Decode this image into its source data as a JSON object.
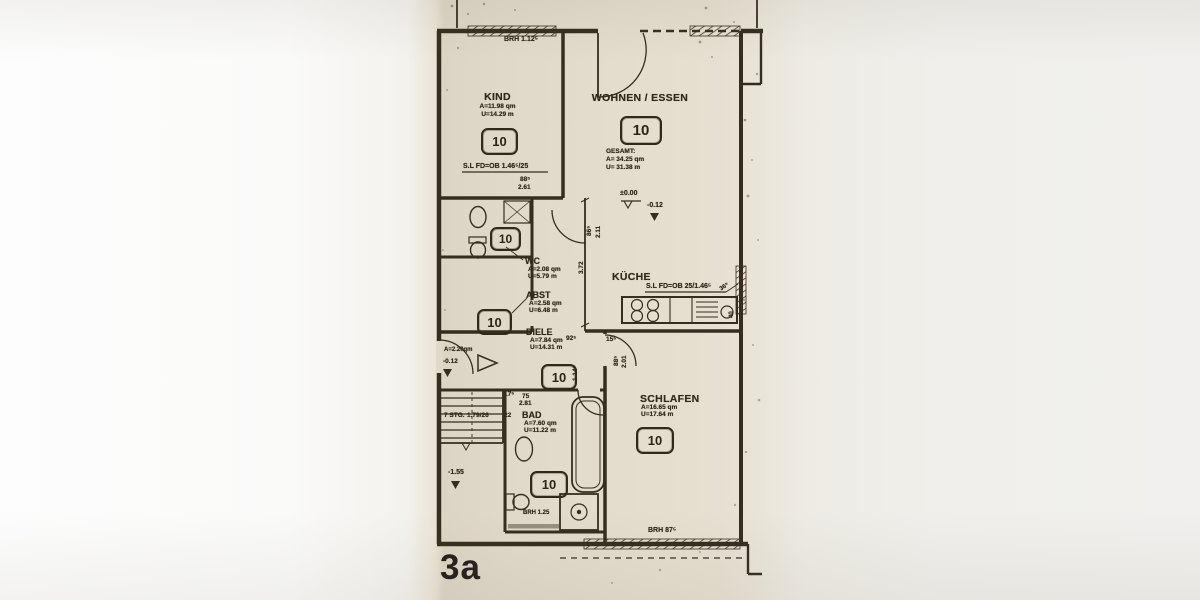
{
  "sheet": {
    "corner_label": "3a"
  },
  "rooms": {
    "kind": {
      "name": "KIND",
      "area": "A=11.98 qm",
      "perimeter": "U=14.29 m",
      "number": "10"
    },
    "wohnen": {
      "name": "WOHNEN / ESSEN",
      "number": "10",
      "gesamt_label": "GESAMT:",
      "area": "A= 34.25 qm",
      "perimeter": "U= 31.38 m"
    },
    "wc": {
      "name": "WC",
      "area": "A=2.08 qm",
      "perimeter": "U=5.79 m",
      "number": "10"
    },
    "abst": {
      "name": "ABST",
      "area": "A=2.58 qm",
      "perimeter": "U=6.48 m",
      "number": "10"
    },
    "diele": {
      "name": "DIELE",
      "area": "A=7.84 qm",
      "perimeter": "U=14.31 m",
      "number": "10"
    },
    "kueche": {
      "name": "KÜCHE"
    },
    "bad": {
      "name": "BAD",
      "area": "A=7.60 qm",
      "perimeter": "U=11.22 m",
      "number": "10",
      "brh": "BRH 1.25"
    },
    "schlafen": {
      "name": "SCHLAFEN",
      "area": "A=16.65 qm",
      "perimeter": "U=17.64 m",
      "number": "10"
    },
    "entry": {
      "area": "A=2.20qm",
      "level": "-0.12"
    }
  },
  "annotations": {
    "brh_top": "BRH 1.12⁵",
    "sl_left": "S.L FD=OB 1.46⁵/25",
    "sl_right": "S.L FD=OB 25/1.46⁵",
    "brh_bottom": "BRH 87⁵",
    "level_zero": "±0.00",
    "level_minus012": "-0.12",
    "level_minus155": "-1.55",
    "stairs_steps": "7 STG.",
    "stairs_dim": "1.79/26",
    "d88": "88⁵",
    "d261": "2.61",
    "d865": "86⁵",
    "d211": "2.11",
    "d372": "3.72",
    "d925": "92⁵",
    "d1145": "1.14⁵",
    "d155": "15⁵",
    "d885b": "88⁵",
    "d201": "2.01",
    "d175": "17⁵",
    "d22": "22",
    "d75": "75",
    "d281": "2.81",
    "d22b": "22",
    "d365": "36⁵",
    "d40": "40"
  }
}
